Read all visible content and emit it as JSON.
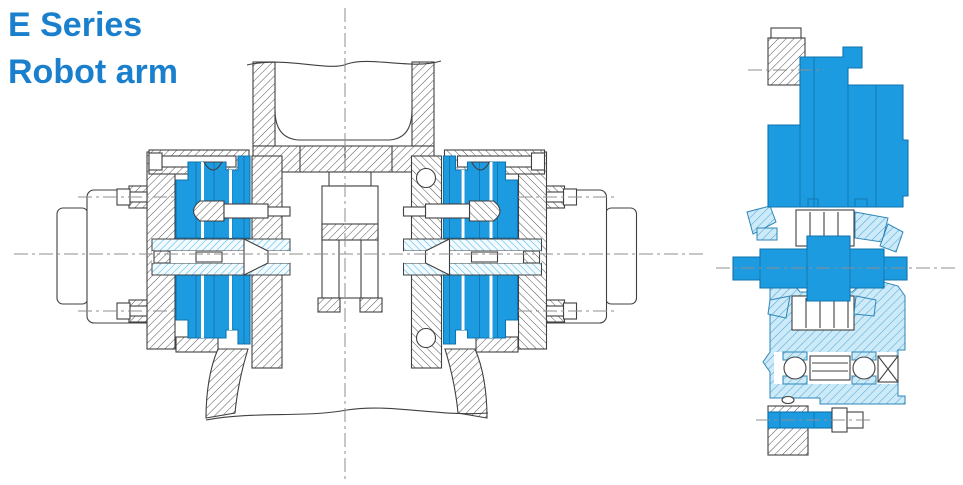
{
  "canvas": {
    "width": 963,
    "height": 485,
    "background": "#ffffff"
  },
  "title": {
    "line1": "E Series",
    "line2": "Robot arm"
  },
  "theme": {
    "title_color": "#1a80cd",
    "highlight_blue": "#1d9be0",
    "highlight_blue_dark": "#1173ad",
    "line_color": "#404040",
    "centerline_color": "#8f8f8f",
    "shaft_hatch_cyan": "#49b8e8",
    "housing_fill": "#cdeaf8",
    "housing_hatch": "#4fa8d8"
  },
  "figures": {
    "front_section": {
      "name": "robot-arm-joint-front-section"
    },
    "side_section": {
      "name": "robot-arm-wrist-side-section"
    }
  }
}
